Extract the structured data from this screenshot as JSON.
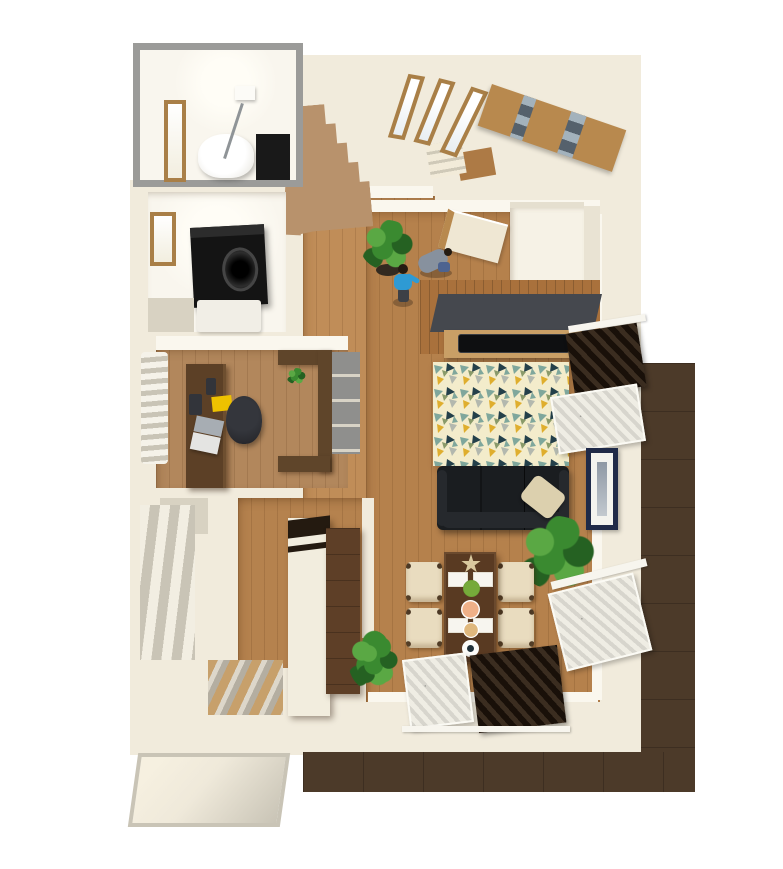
{
  "meta": {
    "title": "3D bird's-eye floor plan of a furnished one-storey home with LDK, study, bathroom, laundry, staircase and balcony"
  },
  "palette": {
    "bg": "#ffffff",
    "wall_cream": "#f1ebdc",
    "wall_face": "#faf7ee",
    "wall_shadow": "#d8d2c2",
    "frame_gray": "#9b9b99",
    "room_white": "#f9f6ee",
    "floor_hall": "#c08d58",
    "floor_living": "#b5814c",
    "floor_study": "#b2875c",
    "floor_kitchen": "#b5824e",
    "stair_tan": "#b8926c",
    "step_cream": "#f2ebd9",
    "step_shadow": "#cfc9b8",
    "landing_wood": "#ad7a45",
    "balcony": "#4c3a29",
    "bay_light": "#f6f0e0",
    "bay_dark": "#c9c4b6",
    "door_wood": "#b8894e",
    "door_glass": "#55616c",
    "glass_light": "#a3b2bc",
    "slit_frame": "#a97f47",
    "accent_wood": "#a9713c",
    "shelf_dark": "#45484e",
    "tv_black": "#0e0f11",
    "tv_board": "#c99f66",
    "rug_base": "#f3eccb",
    "rug_teal": "#7fa79c",
    "rug_navy": "#24404a",
    "rug_yellow": "#dfae2e",
    "rug_gray": "#b3b8ae",
    "rug_olive": "#8a9a6a",
    "sofa_black": "#1a1d20",
    "sofa_edge": "#26292d",
    "cushion_beige": "#dcd0ae",
    "table_walnut": "#593a22",
    "chair_beige": "#e9dcbf",
    "chair_leg": "#4a3724",
    "placemat_white": "#f7f5ef",
    "star_beige": "#d9c89e",
    "salad_green": "#76aa3a",
    "dish_salmon": "#efb088",
    "dish_tan": "#dfb87e",
    "plate_white": "#fcfcf9",
    "drape_brown": "#3b2d20",
    "drape_dark": "#191009",
    "sheer": "#efede4",
    "sheer_shadow": "#c9c4b6",
    "frame_navy": "#1f2a48",
    "fridge_cream": "#f2edde",
    "fridge_cap": "#241a10",
    "cupboard": "#5e3f27",
    "counter_brown": "#5f452a",
    "cabinet_gray": "#8f8f8d",
    "desk_brown": "#5c4026",
    "chair_black": "#2a2b30",
    "laptop_screen": "#a7adb3",
    "laptop_body": "#e4e4e2",
    "note_yellow": "#eec200",
    "device_dark": "#32343a",
    "washer_black": "#141414",
    "vanity_white": "#f1eee6",
    "person_blue": "#2e9ad4",
    "person_gray": "#87919e",
    "hair_dark": "#241b12",
    "denim": "#4d6390",
    "mat_tan": "#c7a06b",
    "mat_gray": "#b4aea1",
    "plant_green": "#3a8a30",
    "plant_dark": "#256122",
    "plant_light": "#5aa844",
    "pot_brown": "#332a20"
  },
  "labels": {
    "floor_plan": "3D floor plan",
    "bathroom": "Unit bathroom",
    "bathtub": "Bathtub",
    "bath_door": "Bathroom door",
    "bath_panel": "Bath control panel",
    "shower": "Shower bar",
    "vent": "Ceiling vent",
    "laundry": "Laundry / washroom",
    "laundry_window": "Washroom window",
    "washer": "Drum washing machine",
    "vanity": "Washbasin vanity",
    "study": "Study room",
    "study_curtain": "Study curtain",
    "desk": "Work desk",
    "laptop": "Laptop",
    "notepad": "Yellow notepad",
    "phone": "Phone",
    "calculator": "Calculator",
    "office_chair": "Office chair",
    "counter": "L-shaped counter shelf",
    "cabinets": "Gray cabinet fronts",
    "counter_plant": "Small potted plant",
    "storage_shelf": "Open storage shelving",
    "kitchen": "Kitchen corridor",
    "kitchen_mat": "Striped kitchen mat",
    "fridge": "Refrigerator",
    "cupboard": "Tall wooden cupboard",
    "hallway": "Hallway",
    "hall_plant": "Potted plant",
    "person_standing": "Person in blue shirt",
    "person_crouching": "Crouching person",
    "hall_door": "Hallway door",
    "stairs": "Staircase",
    "steps": "Lower stair steps",
    "landing": "Wooden stair landing",
    "slit_window": "Slit window",
    "entrance": "Entrance",
    "front_door": "Wooden front door with glass slits",
    "shoe_closet": "Entrance closet",
    "living": "Living / dining room",
    "accent_wall": "Wood accent wall",
    "wall_shelf": "Floating wall shelf",
    "tv": "Flat-screen TV",
    "tv_board": "TV board",
    "rug": "Triangle-pattern rug",
    "sofa": "Black leather sofa",
    "cushion": "Beige cushion",
    "sofa_plant": "Large potted plant",
    "dining_table": "Dining table",
    "dining_chair": "Dining chair",
    "placemat": "Placemat",
    "star_dish": "Star-shaped ornament",
    "salad_bowl": "Salad bowl",
    "dish": "Serving dish",
    "plate": "Plate with cup",
    "drape": "Brown pleated drape",
    "sheer": "White sheer curtain",
    "rail": "Curtain rail",
    "picture": "Framed picture",
    "balcony": "Wood-deck balcony",
    "bay_window": "Bay window nook",
    "wall": "Wall",
    "floor": "Wood floor"
  }
}
